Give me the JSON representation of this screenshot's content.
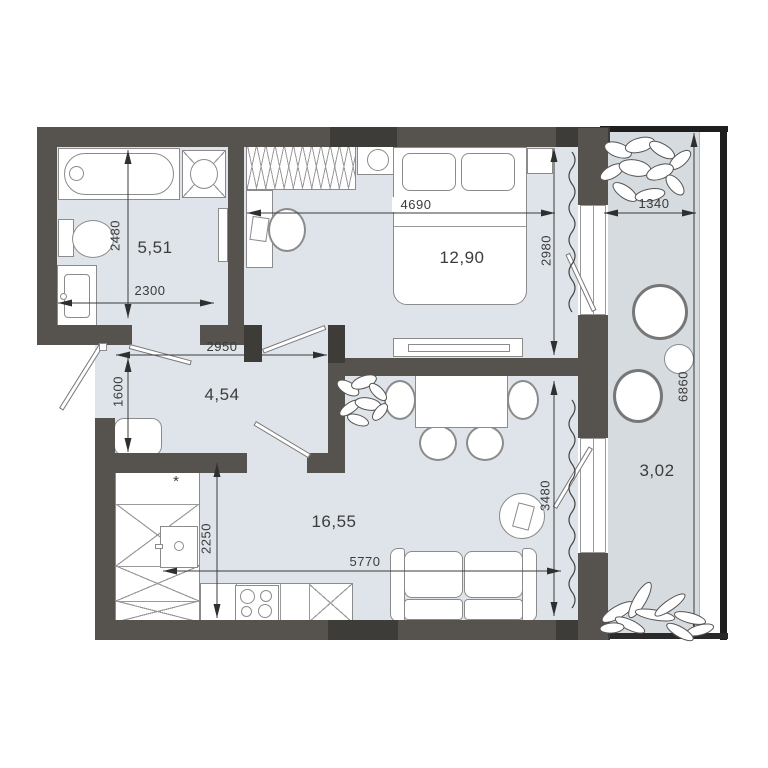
{
  "areas": {
    "bathroom": "5,51",
    "bedroom": "12,90",
    "hallway": "4,54",
    "living": "16,55",
    "balcony": "3,02"
  },
  "dimensions": {
    "bathroom_height": "2480",
    "bathroom_width": "2300",
    "bedroom_width": "4690",
    "bedroom_height": "2980",
    "hallway_width": "2950",
    "hallway_height": "1600",
    "kitchen_depth": "2250",
    "living_width": "5770",
    "living_height": "3480",
    "balcony_width": "1340",
    "balcony_height": "6860"
  },
  "symbols": {
    "footnote": "*"
  },
  "colors": {
    "wall": "#56534e",
    "wall_dark": "#3e3c39",
    "room_fill": "#dee4e9",
    "balcony_fill": "#d5dbdf",
    "outline": "#8b8b8b",
    "text": "#3b3b3b"
  }
}
